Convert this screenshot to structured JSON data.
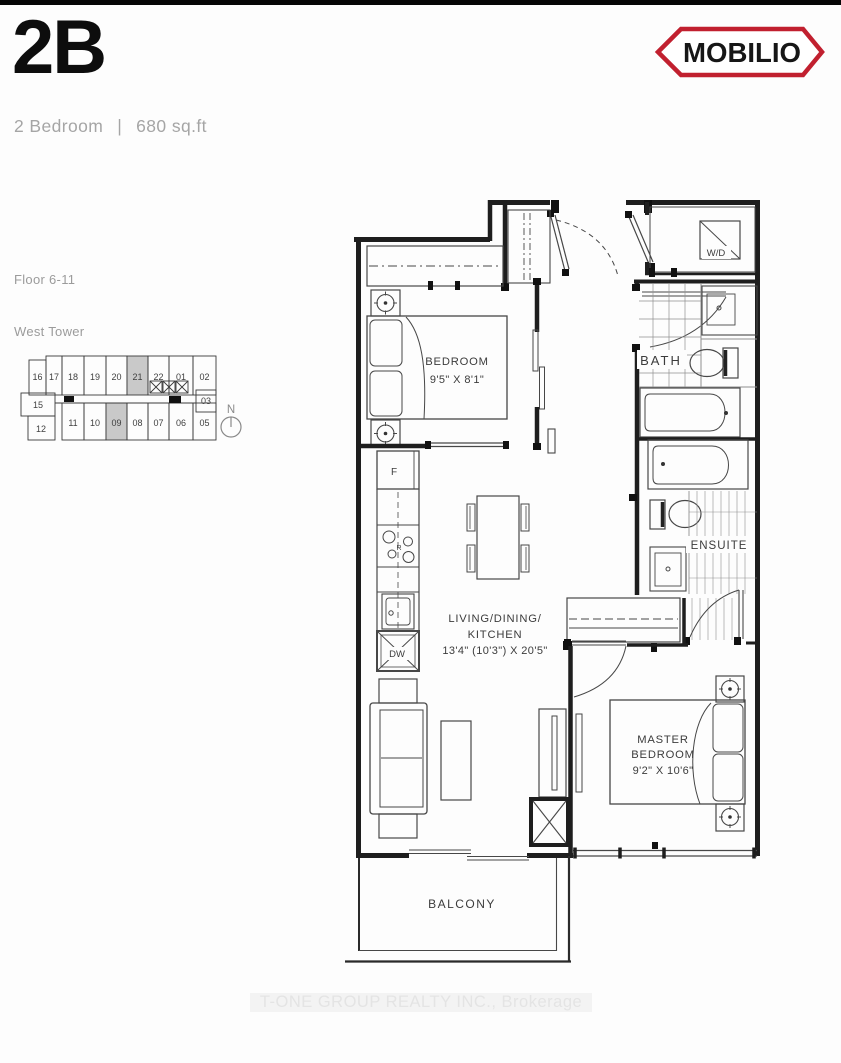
{
  "header": {
    "unit_code": "2B",
    "unit_type": "2 Bedroom",
    "separator": "|",
    "area": "680 sq.ft",
    "brand_name": "MOBILIO"
  },
  "info": {
    "floor_label": "Floor 6-11",
    "tower_label": "West Tower"
  },
  "keyplate": {
    "top_row": [
      "16",
      "17",
      "18",
      "19",
      "20",
      "21",
      "22",
      "01",
      "02"
    ],
    "bottom_row": [
      "11",
      "10",
      "09",
      "08",
      "07",
      "06",
      "05"
    ],
    "unit_15": "15",
    "unit_12": "12",
    "unit_03": "03",
    "highlighted_units": [
      "21",
      "09"
    ],
    "highlight_color": "#c9c9c9",
    "north_label": "N"
  },
  "floorplan": {
    "bedroom": {
      "label": "BEDROOM",
      "dims": "9'5\" X 8'1\""
    },
    "master": {
      "label_line1": "MASTER",
      "label_line2": "BEDROOM",
      "dims": "9'2\" X 10'6\""
    },
    "living": {
      "label_line1": "LIVING/DINING/",
      "label_line2": "KITCHEN",
      "dims": "13'4\" (10'3\") X 20'5\""
    },
    "bath": {
      "label": "BATH"
    },
    "ensuite": {
      "label": "ENSUITE"
    },
    "balcony": {
      "label": "BALCONY"
    },
    "fixtures": {
      "fridge": "F",
      "range": "R",
      "dishwasher": "DW",
      "washer_dryer": "W/D"
    }
  },
  "watermark": "T-ONE GROUP REALTY INC., Brokerage",
  "colors": {
    "brand_red": "#c1202f",
    "wall": "#1e1e1e",
    "text_gray": "#a5a5a5"
  }
}
